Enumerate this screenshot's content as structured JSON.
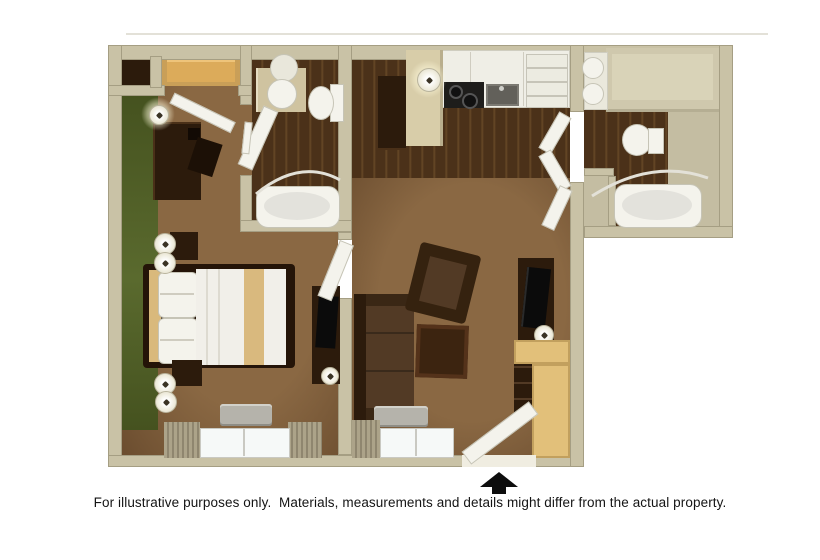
{
  "image_type": "3d-top-down-floor-plan",
  "caption": "For illustrative purposes only.  Materials, measurements and details might differ from the actual property.",
  "entrance": {
    "indicator": "black-up-arrow",
    "location": "bottom-center of living room"
  },
  "rooms": [
    {
      "name": "bedroom",
      "items": [
        "green-accent-wall",
        "double-bed",
        "pillows",
        "tan-bed-runner",
        "nightstand",
        "table-lamps",
        "desk",
        "desk-chair",
        "desk-lamp",
        "dresser-with-tv",
        "closet",
        "closet-shelf",
        "window",
        "curtains",
        "air-conditioner"
      ]
    },
    {
      "name": "bathroom-1",
      "items": [
        "vanity-counter",
        "round-sink",
        "toilet",
        "bathtub",
        "shower-curtain-rod",
        "open-door"
      ]
    },
    {
      "name": "kitchen",
      "items": [
        "counter",
        "stove",
        "sink",
        "refrigerator",
        "breakfast-bar",
        "pantry-cabinet",
        "ceiling-light",
        "dark-wood-floor"
      ]
    },
    {
      "name": "living-room",
      "items": [
        "sofa",
        "armchair",
        "coffee-table",
        "tv-cabinet",
        "television",
        "bookshelf",
        "writing-desk",
        "window",
        "curtains",
        "air-conditioner",
        "entry-door"
      ]
    },
    {
      "name": "bathroom-2",
      "items": [
        "double-vanity-sinks",
        "vanity-counter",
        "toilet",
        "bathtub",
        "shower-curtain-rod",
        "linen-closet",
        "dark-wood-floor"
      ]
    }
  ],
  "colors": {
    "wall": "#c9c2a6",
    "wall_edge": "#a59e83",
    "wall_light": "#ddd7c0",
    "carpet": "#8a6843",
    "carpet_dark": "#6b4d2f",
    "wood": "#4b3119",
    "wood_light": "#6a4a28",
    "green": "#45521f",
    "green_light": "#5a6a2e",
    "white_fx": "#f4f3ec",
    "fx_border": "#c6c4b6",
    "dark_furn": "#2c1b0c",
    "mid_furn": "#523a25",
    "light_wood": "#e2c07a",
    "light_wood_edge": "#c2a05e",
    "counter": "#efeee6",
    "tan_floor": "#c4bda2",
    "glass": "#f6f9f8",
    "curtain": "#aca389",
    "ac": "#b5b3ab",
    "black": "#0d0d0d",
    "line": "#e3e1d8"
  }
}
